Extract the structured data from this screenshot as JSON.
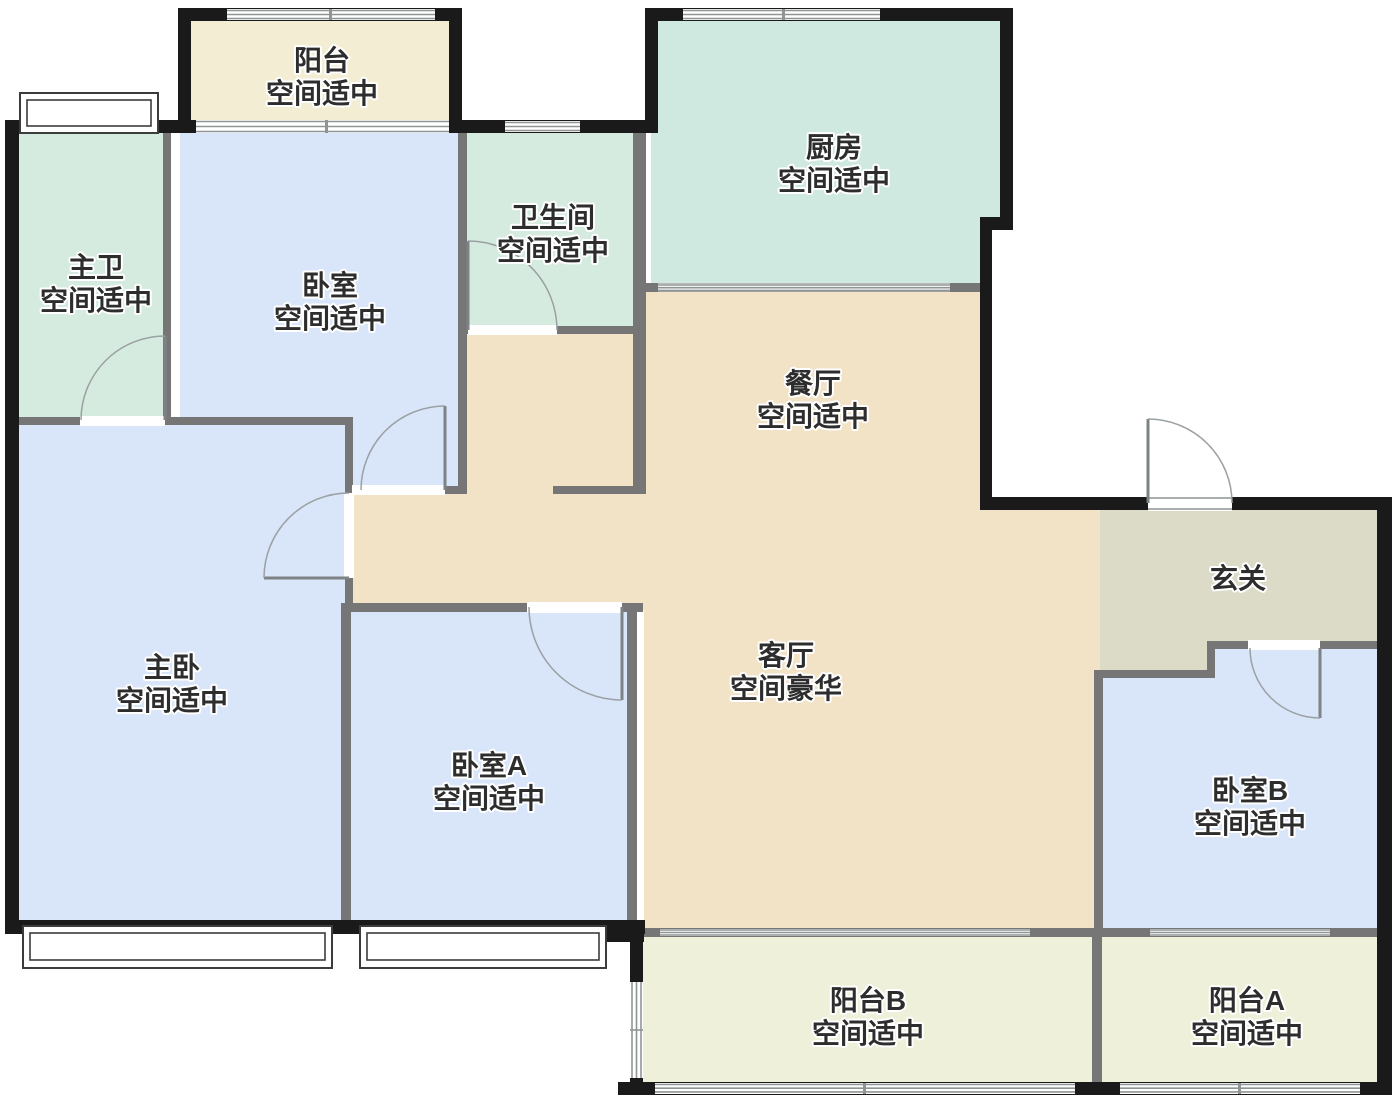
{
  "plan_type": "apartment-floorplan",
  "rooms": [
    {
      "id": "balcony-top",
      "name": "阳台",
      "status": "空间适中",
      "color": "#f3eed3"
    },
    {
      "id": "master-bath",
      "name": "主卫",
      "status": "空间适中",
      "color": "#d6ebdf"
    },
    {
      "id": "bedroom",
      "name": "卧室",
      "status": "空间适中",
      "color": "#d9e5f8"
    },
    {
      "id": "bathroom",
      "name": "卫生间",
      "status": "空间适中",
      "color": "#d6ebdf"
    },
    {
      "id": "kitchen",
      "name": "厨房",
      "status": "空间适中",
      "color": "#cfe9e0"
    },
    {
      "id": "dining-room",
      "name": "餐厅",
      "status": "空间适中",
      "color": "#f2e2c6"
    },
    {
      "id": "master-bedroom",
      "name": "主卧",
      "status": "空间适中",
      "color": "#d9e5f8"
    },
    {
      "id": "bedroom-a",
      "name": "卧室A",
      "status": "空间适中",
      "color": "#d9e5f8"
    },
    {
      "id": "living-room",
      "name": "客厅",
      "status": "空间豪华",
      "color": "#f2e2c6"
    },
    {
      "id": "foyer",
      "name": "玄关",
      "status": "",
      "color": "#dbdbc8"
    },
    {
      "id": "bedroom-b",
      "name": "卧室B",
      "status": "空间适中",
      "color": "#d9e5f8"
    },
    {
      "id": "balcony-b",
      "name": "阳台B",
      "status": "空间适中",
      "color": "#eff0d9"
    },
    {
      "id": "balcony-a",
      "name": "阳台A",
      "status": "空间适中",
      "color": "#eff0d9"
    }
  ],
  "palette": {
    "background": "#ffffff",
    "exterior_wall": "#1a1a1a",
    "interior_wall": "#767676",
    "window_line": "#8f9494",
    "door_arc": "#9aa0a3",
    "label_text": "#2d2d2d"
  }
}
